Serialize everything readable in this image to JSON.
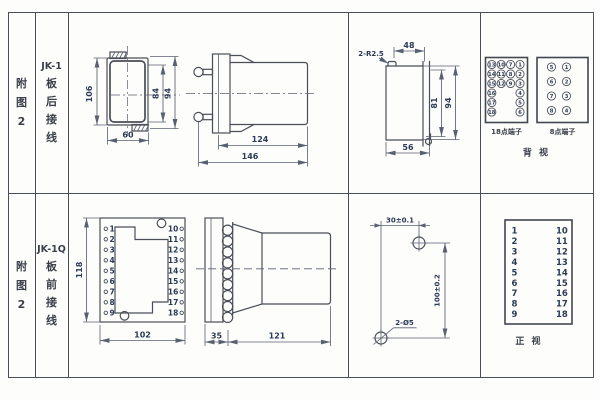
{
  "colors": {
    "line": "#4a4e56",
    "text": "#3a3f49",
    "dim": "#2c3a57"
  },
  "row1": {
    "fig_label": [
      "附",
      "图",
      "2"
    ],
    "model": "JK-1",
    "wiring_label": [
      "板",
      "后",
      "接",
      "线"
    ],
    "front_view": {
      "dim_height": "106",
      "dim_inner": "84",
      "dim_flange": "94",
      "dim_width": "60"
    },
    "side_view": {
      "dim_body": "124",
      "dim_total": "146"
    },
    "cutout_view": {
      "corner_radius": "2-R2.5",
      "dim_top": "48",
      "dim_inner": "81",
      "dim_outer": "94",
      "dim_bottom": "56"
    },
    "back_view": {
      "caption": "背  视",
      "t18_label": "18点端子",
      "t8_label": "8点端子",
      "t18_col1": [
        "13",
        "14",
        "15",
        "16",
        "17",
        "18"
      ],
      "t18_col2": [
        "10",
        "11",
        "12"
      ],
      "t18_col3": [
        "7",
        "8",
        "9"
      ],
      "t18_col4": [
        "1",
        "2",
        "3",
        "4",
        "5",
        "6"
      ],
      "t8_col1": [
        "5",
        "6",
        "7",
        "8"
      ],
      "t8_col2": [
        "1",
        "2",
        "3",
        "4"
      ]
    }
  },
  "row2": {
    "fig_label": [
      "附",
      "图",
      "2"
    ],
    "model": "JK-1Q",
    "wiring_label": [
      "板",
      "前",
      "接",
      "线"
    ],
    "front_view": {
      "dim_height": "118",
      "dim_width": "102",
      "left_terminals": [
        "1",
        "2",
        "3",
        "4",
        "5",
        "6",
        "7",
        "8",
        "9"
      ],
      "right_terminals": [
        "10",
        "11",
        "12",
        "13",
        "14",
        "15",
        "16",
        "17",
        "18"
      ]
    },
    "side_view": {
      "dim_panel": "35",
      "dim_body": "121"
    },
    "drill_view": {
      "dim_x": "30±0.1",
      "dim_y": "100±0.2",
      "hole_label": "2-Ø5"
    },
    "front_table": {
      "caption": "正  视",
      "left": [
        "1",
        "2",
        "3",
        "4",
        "5",
        "6",
        "7",
        "8",
        "9"
      ],
      "right": [
        "10",
        "11",
        "12",
        "13",
        "14",
        "15",
        "16",
        "17",
        "18"
      ]
    }
  }
}
